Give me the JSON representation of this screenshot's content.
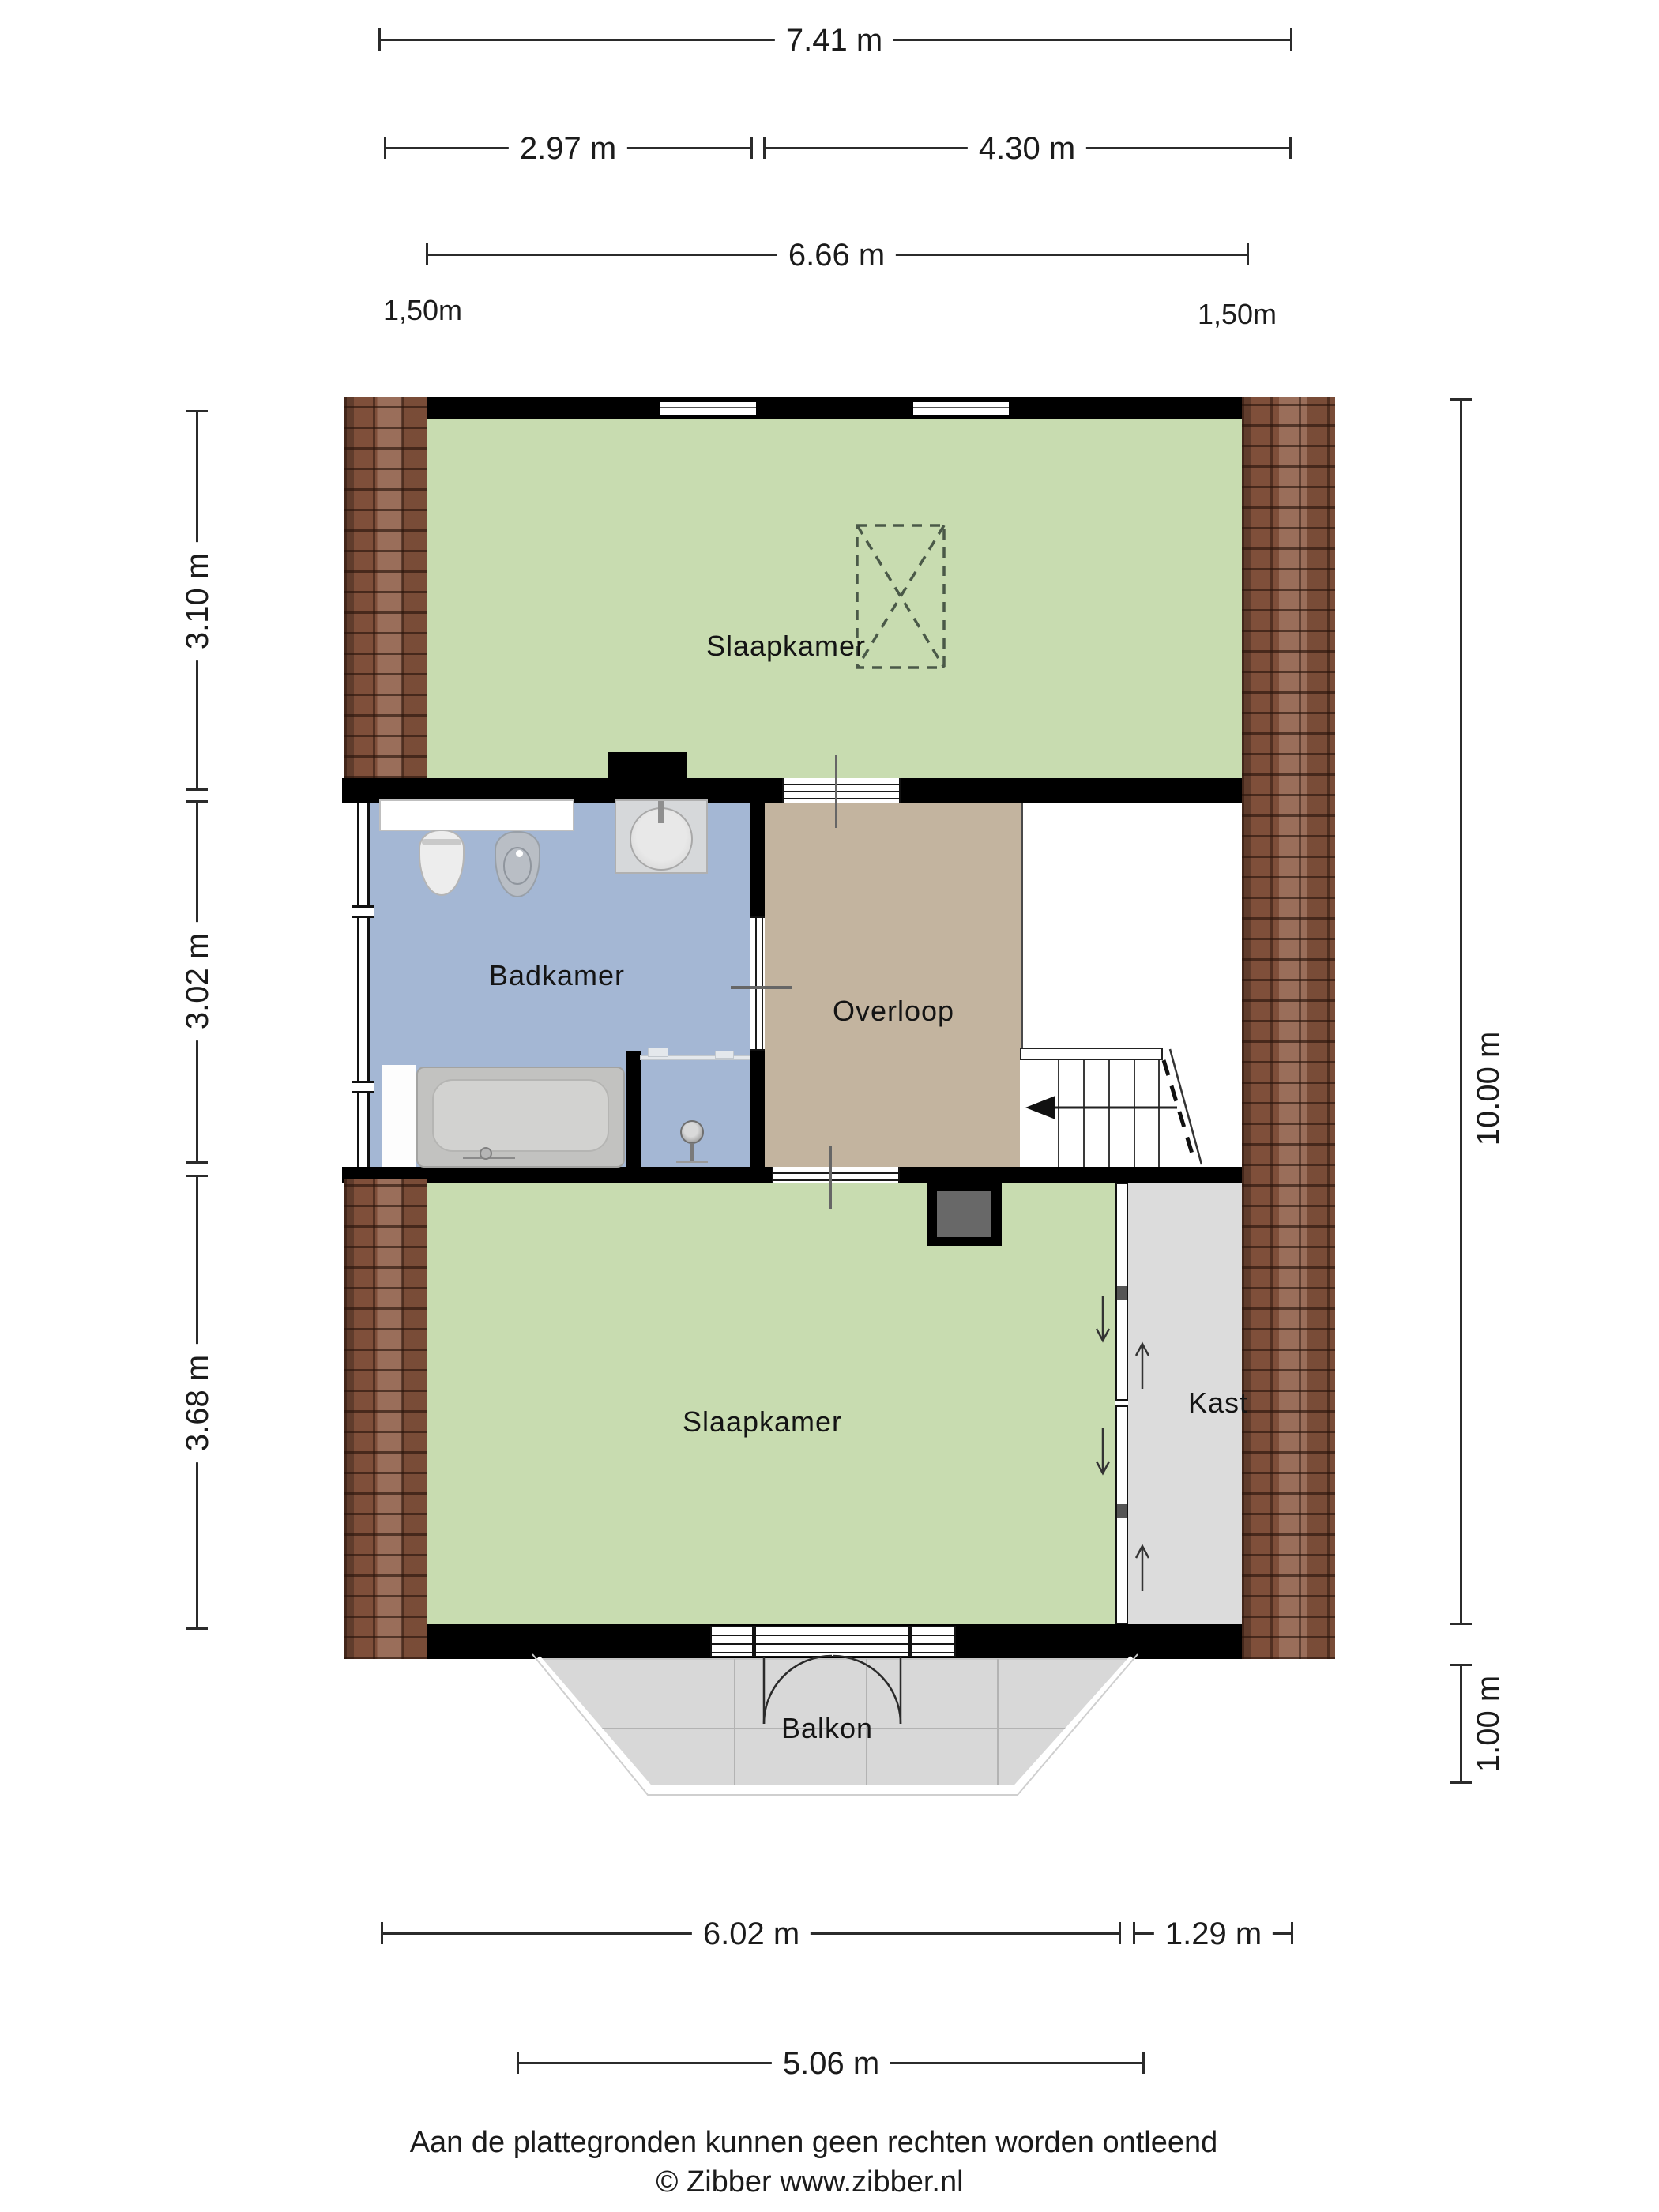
{
  "dimensions": {
    "top_total": "7.41 m",
    "top_left": "2.97 m",
    "top_right": "4.30 m",
    "top_inner": "6.66 m",
    "knee_left": "1,50m",
    "knee_right": "1,50m",
    "left": [
      {
        "label": "3.10 m"
      },
      {
        "label": "3.02 m"
      },
      {
        "label": "3.68 m"
      }
    ],
    "right_total": "10.00 m",
    "right_balcony": "1.00 m",
    "bottom_main": "6.02 m",
    "bottom_closet": "1.29 m",
    "bottom_balcony": "5.06 m"
  },
  "rooms": {
    "bedroom_top": "Slaapkamer",
    "bathroom": "Badkamer",
    "landing": "Overloop",
    "bedroom_bottom": "Slaapkamer",
    "closet": "Kast",
    "balcony": "Balkon"
  },
  "footer": {
    "disclaimer": "Aan de plattegronden kunnen geen rechten worden ontleend",
    "copyright": "© Zibber www.zibber.nl"
  },
  "colors": {
    "bedroom_floor": "#c8dcb0",
    "bathroom_floor": "#a4b7d4",
    "landing_floor": "#c3b49f",
    "closet_floor": "#dcdcdc",
    "balcony_floor": "#d8d8d8",
    "wall": "#000000",
    "roof_brick": "#8a563f"
  }
}
